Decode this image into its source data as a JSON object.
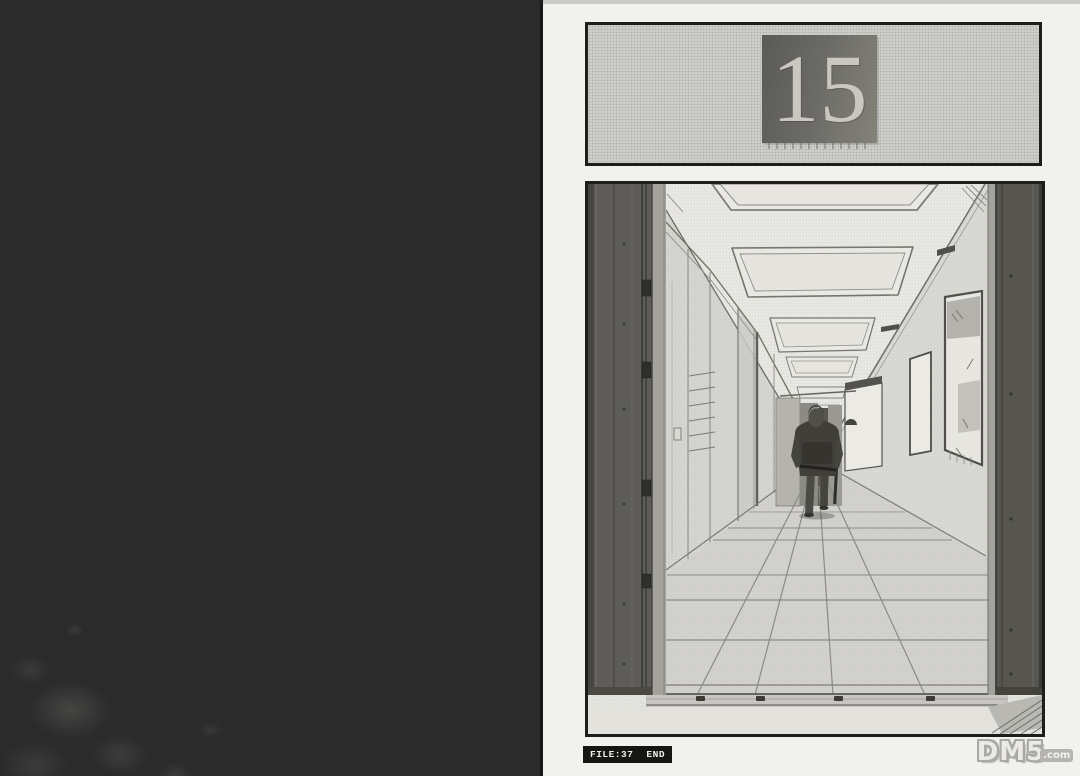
{
  "page": {
    "chapter_panel": {
      "number": "15"
    },
    "footer": {
      "file_label": "FILE:37",
      "end_label": "END"
    },
    "watermark": {
      "site": "DM5",
      "tld": ".com"
    }
  },
  "colors": {
    "void_bg": "#2b2b2b",
    "paper": "#f1f1ef",
    "ink": "#1d1d1b",
    "screentone_light": "#cfceca",
    "plate_dark": "#5b5a56",
    "plate_light": "#848379",
    "caption_bg": "#161614",
    "caption_text": "#efefeb",
    "watermark_fill": "#eceae6",
    "watermark_outline": "#a9a8a4"
  }
}
